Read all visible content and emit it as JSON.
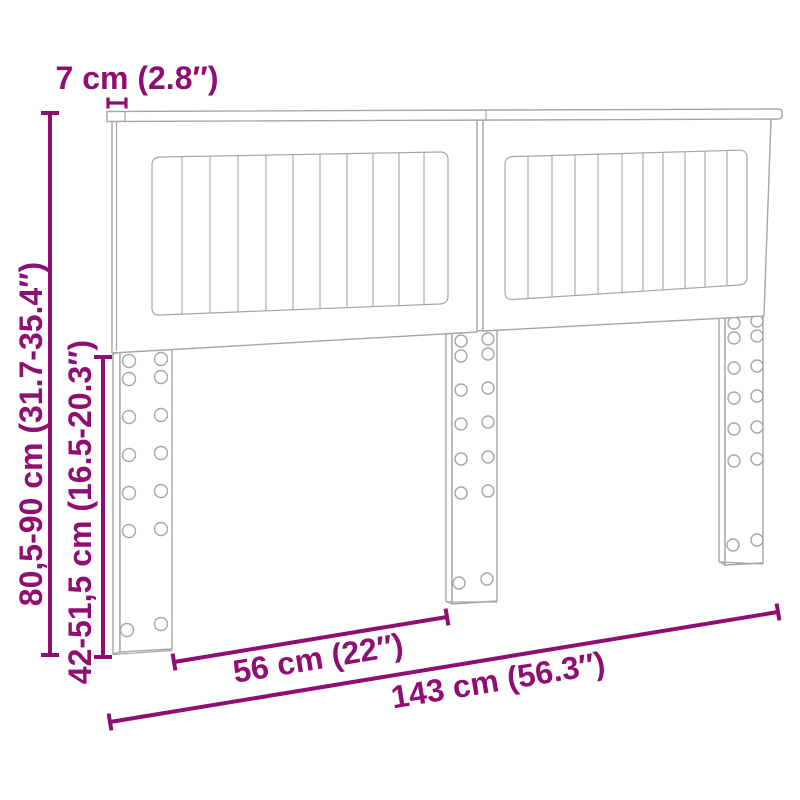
{
  "diagram": {
    "type": "furniture-dimension-diagram",
    "background": "#ffffff",
    "colors": {
      "accent": "#8E0E72",
      "furniture": "#A6A6A6",
      "background": "#FFFFFF"
    },
    "labels": {
      "top_rail_depth": "7 cm (2.8″)",
      "total_height_range": "80,5-90 cm (31.7-35.4″)",
      "leg_height_range": "42-51,5 cm (16.5-20.3″)",
      "leg_distance": "56 cm (22″)",
      "total_width": "143 cm (56.3″)"
    }
  }
}
